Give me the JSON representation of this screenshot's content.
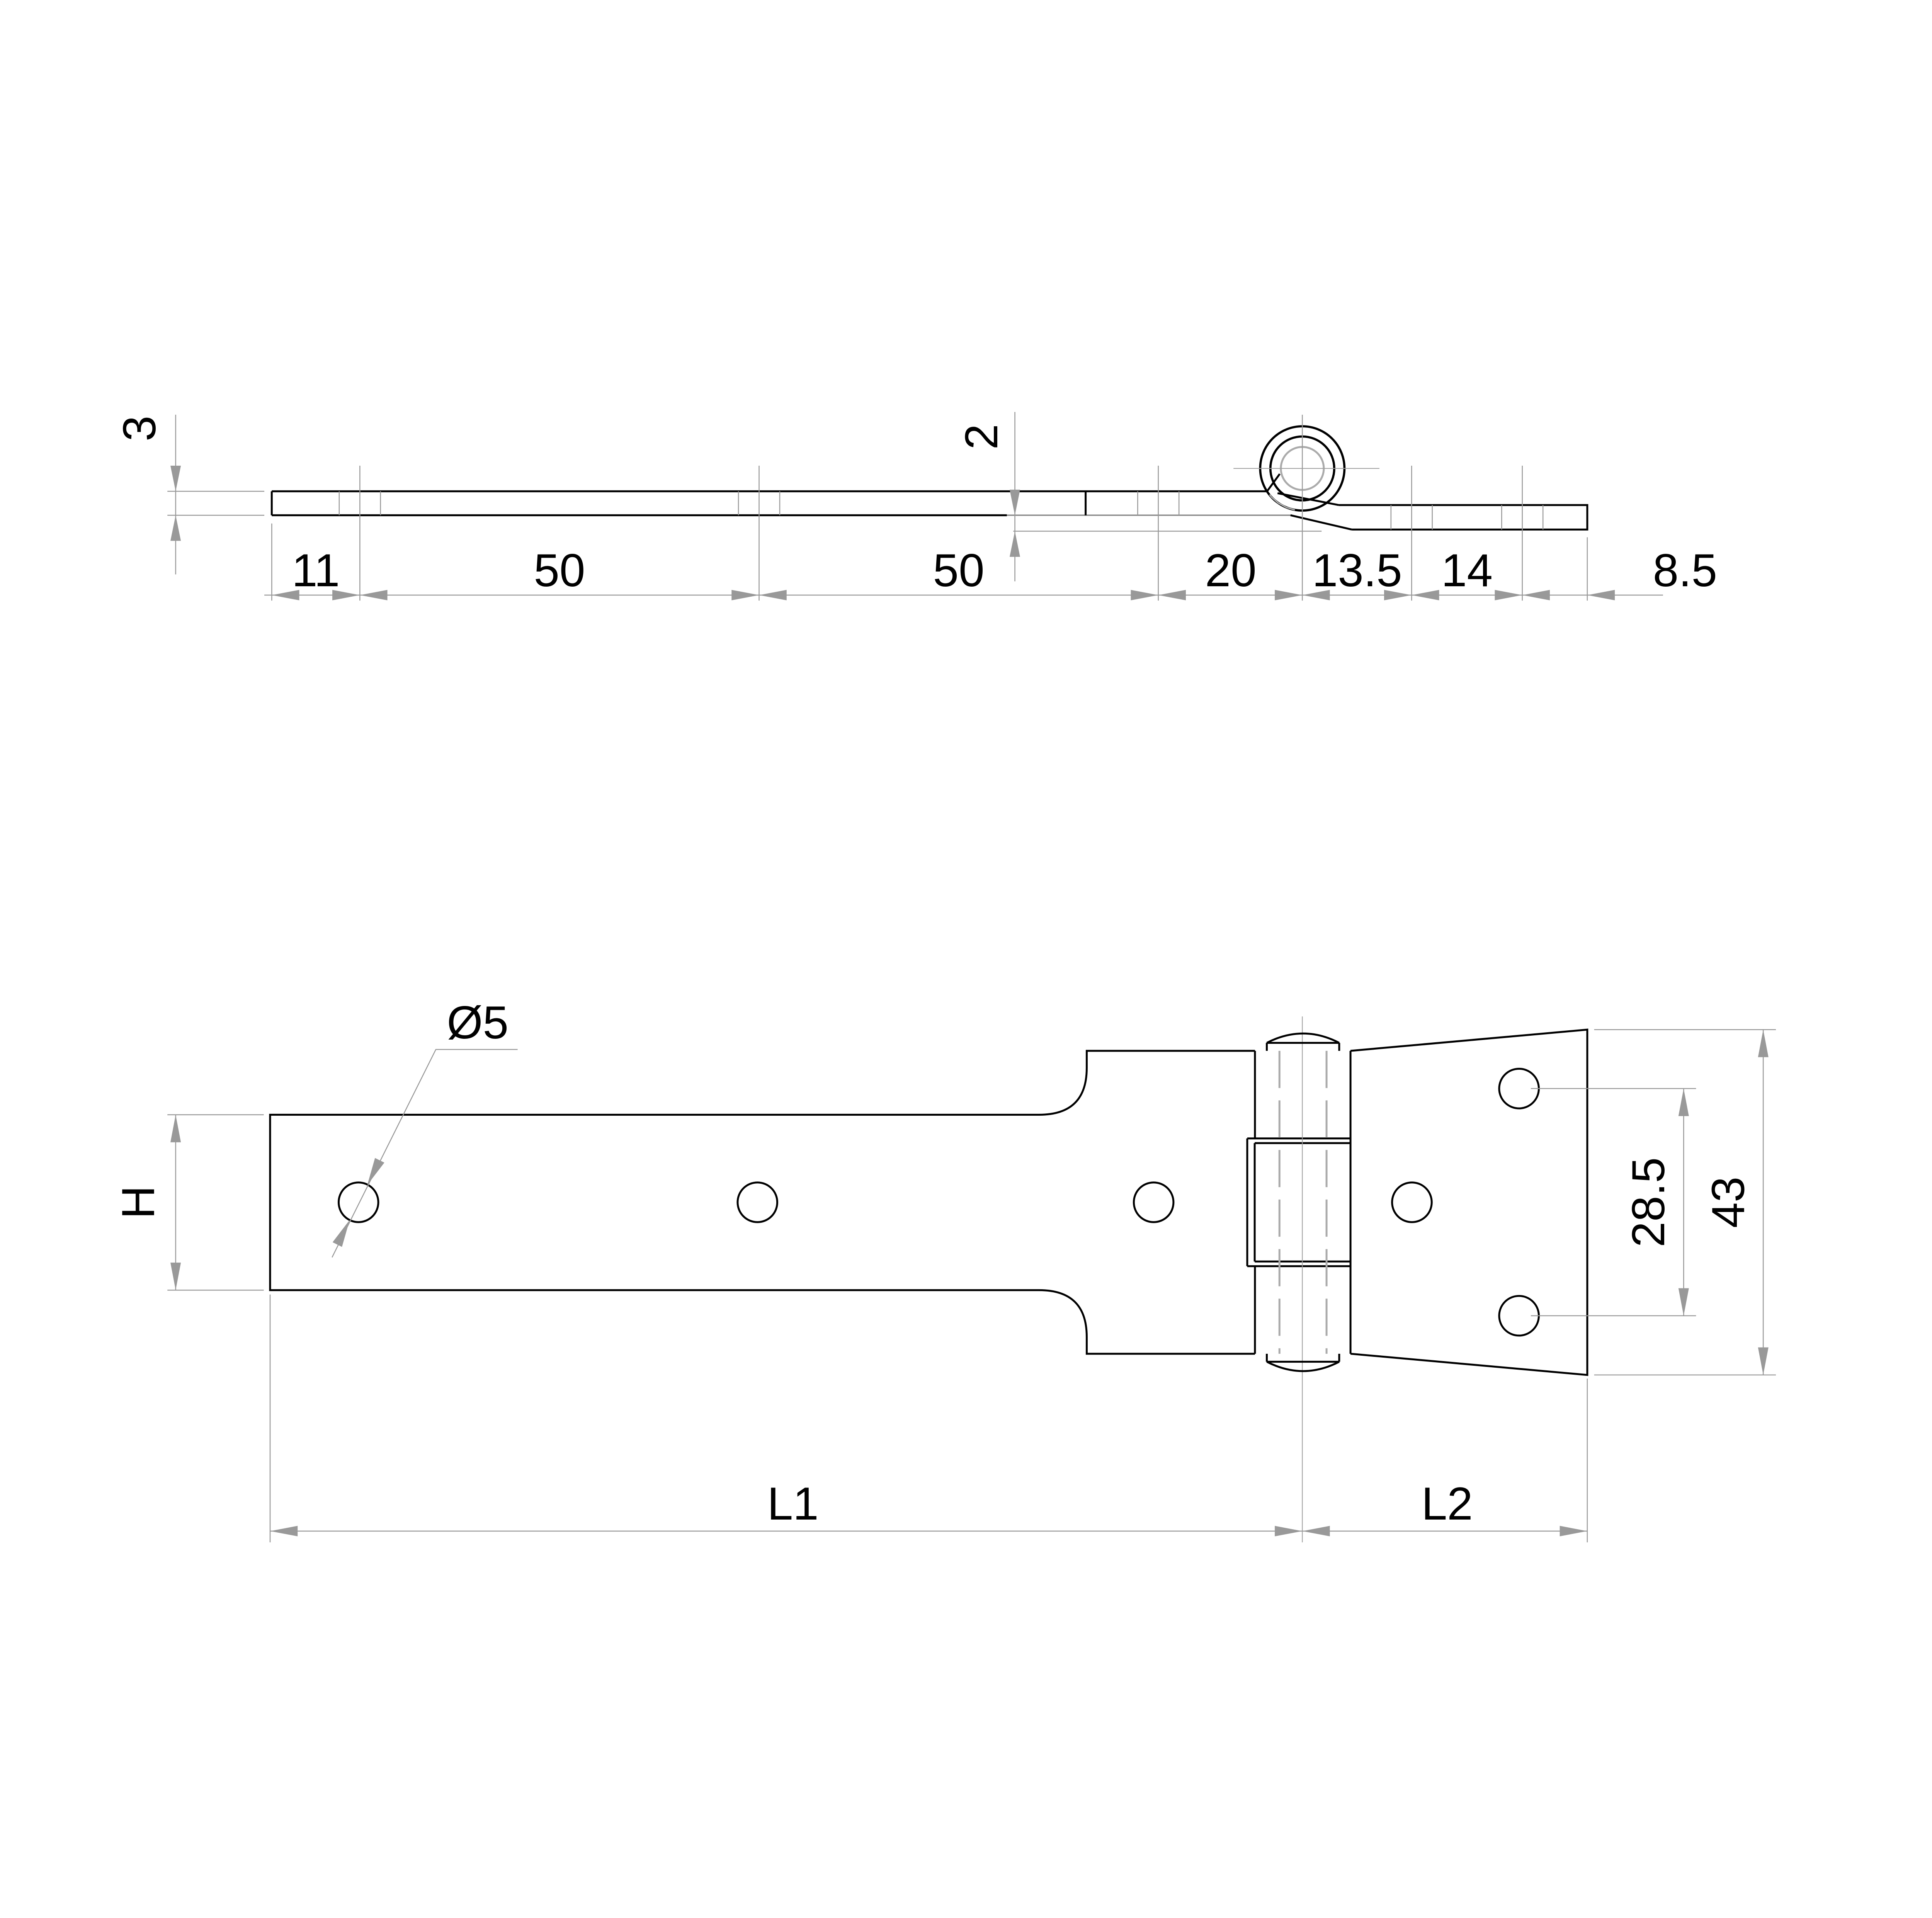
{
  "page": {
    "description": "Engineering drawing of a tee / strap hinge: side profile view above, top plan view below",
    "background": "#ffffff"
  },
  "colors": {
    "outline": "#000000",
    "dimension": "#999999",
    "hidden_detail": "#ababab"
  },
  "side_view": {
    "thickness_label": "3",
    "offset_label": "2",
    "chain_labels": [
      "11",
      "50",
      "50",
      "20",
      "13.5",
      "14",
      "8.5"
    ]
  },
  "plan_view": {
    "hole_diameter_label": "Ø5",
    "width_label": "H",
    "hole_spacing_label": "28.5",
    "plate_width_label": "43",
    "strap_length_label": "L1",
    "plate_length_label": "L2"
  }
}
